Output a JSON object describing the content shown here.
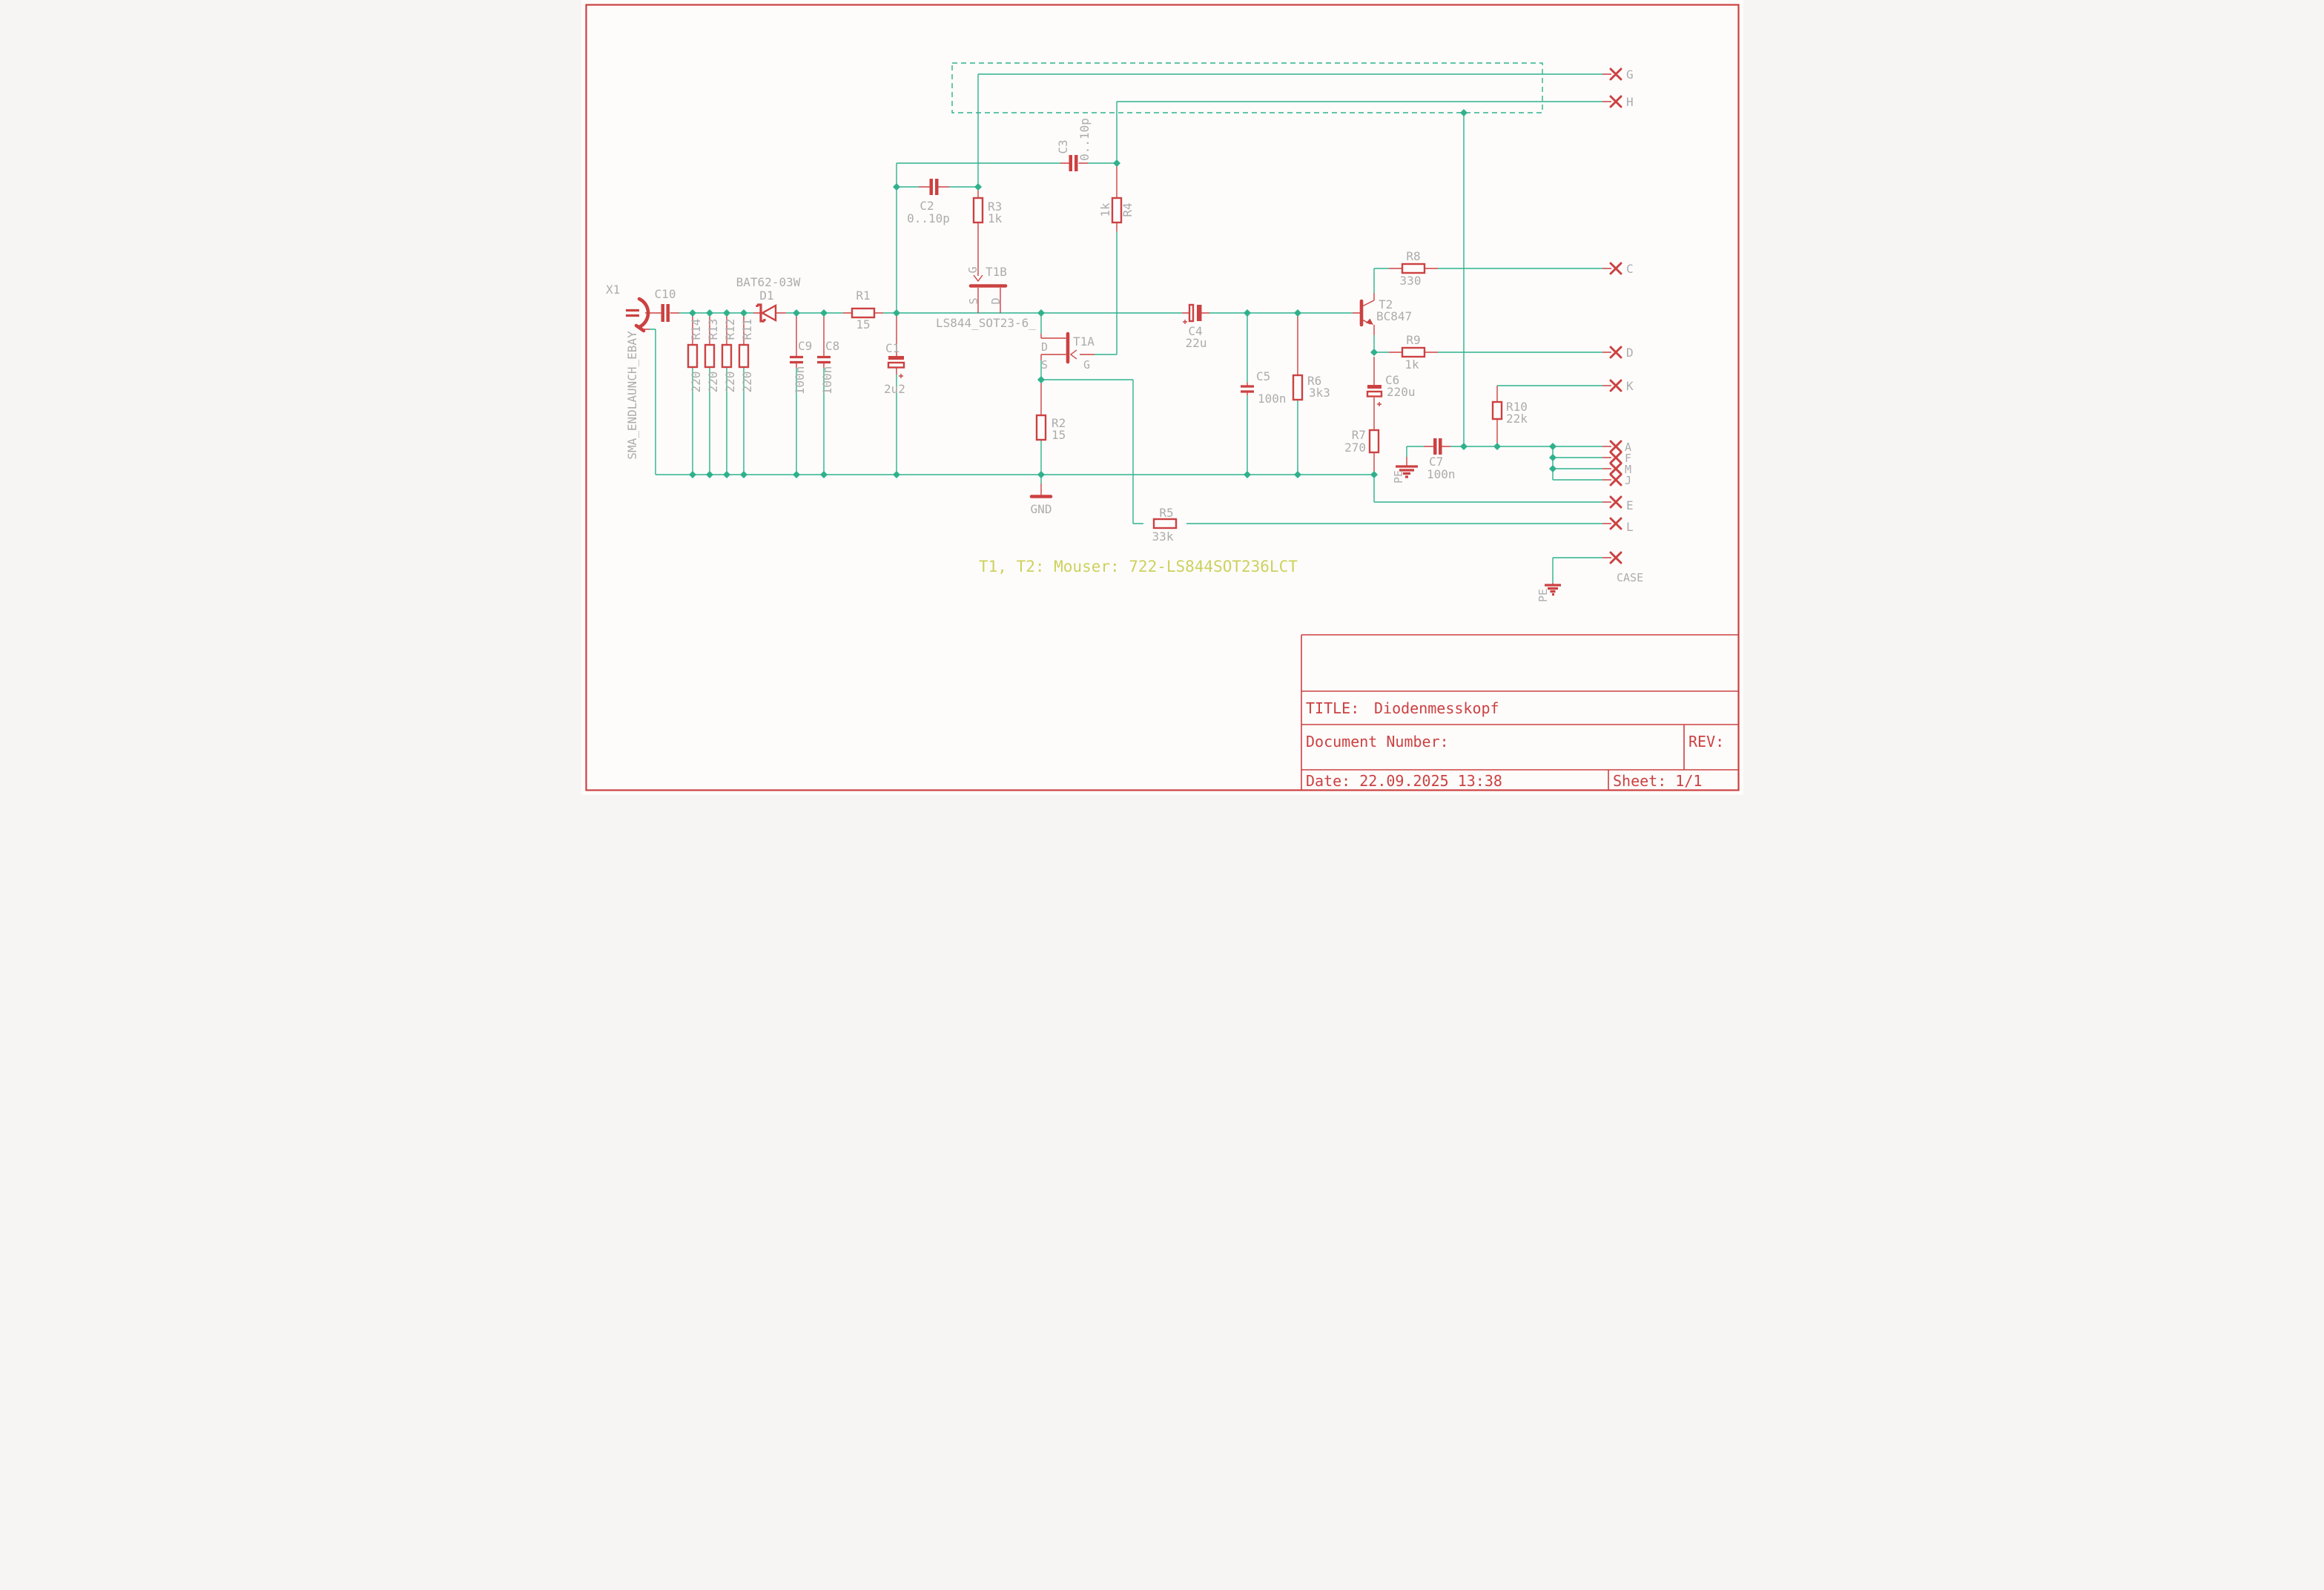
{
  "colors": {
    "wire": "#2FB18C",
    "component": "#CC4141",
    "label": "#ACACAC",
    "note": "#CDD15C",
    "frame": "#CC4141",
    "background": "#fdfcfb"
  },
  "labels": {
    "x1": "X1",
    "sma": "SMA_ENDLAUNCH_EBAY",
    "c10": "C10",
    "r14": "R14",
    "r13": "R13",
    "r12": "R12",
    "r11": "R11",
    "v220": "220",
    "bat": "BAT62-03W",
    "d1": "D1",
    "c9": "C9",
    "c8": "C8",
    "v100n": "100n",
    "r1": "R1",
    "v15": "15",
    "c1": "C1",
    "v2u2": "2u2",
    "c2": "C2",
    "v010p": "0..10p",
    "r3": "R3",
    "v1k": "1k",
    "c3": "C3",
    "r4": "R4",
    "t1b": "T1B",
    "t1a": "T1A",
    "ls844": "LS844_SOT23-6_",
    "pin_g": "G",
    "pin_s": "S",
    "pin_d": "D",
    "r2": "R2",
    "gnd": "GND",
    "c4": "C4",
    "v22u": "22u",
    "c5": "C5",
    "r6": "R6",
    "v3k3": "3k3",
    "t2": "T2",
    "bc847": "BC847",
    "r8": "R8",
    "v330": "330",
    "r9": "R9",
    "c6": "C6",
    "v220u": "220u",
    "r7": "R7",
    "v270": "270",
    "c7": "C7",
    "r10": "R10",
    "v22k": "22k",
    "r5": "R5",
    "v33k": "33k",
    "pe": "PE",
    "case": "CASE"
  },
  "connector_pins": {
    "g": "G",
    "h": "H",
    "c": "C",
    "d": "D",
    "k": "K",
    "a": "A",
    "f": "F",
    "m": "M",
    "j": "J",
    "e": "E",
    "l": "L"
  },
  "note": "T1, T2: Mouser: 722-LS844SOT236LCT",
  "title_block": {
    "title_label": "TITLE:",
    "title": "Diodenmesskopf",
    "document_number_label": "Document Number:",
    "rev_label": "REV:",
    "date": "Date: 22.09.2025 13:38",
    "sheet": "Sheet: 1/1"
  }
}
